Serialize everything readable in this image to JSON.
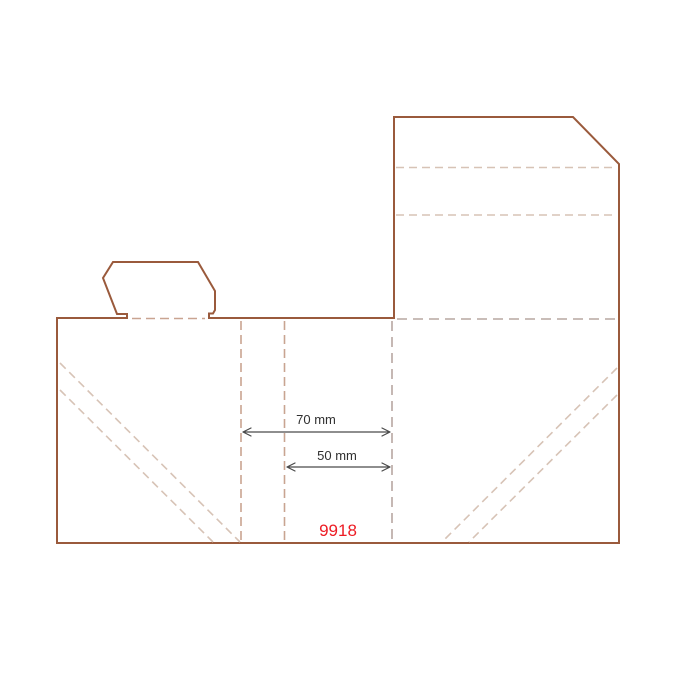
{
  "drawing": {
    "dimension_70": {
      "label": "70 mm",
      "value_mm": 70
    },
    "dimension_50": {
      "label": "50 mm",
      "value_mm": 50
    },
    "drawing_number": {
      "label": "9918"
    }
  },
  "colors": {
    "cut_line": "#9a5a3c",
    "fold_line": "#c9a491",
    "fold_line_light": "#d7c3b6",
    "fold_line_gray": "#b7a7a1",
    "dimension_line": "#4a4a4a",
    "dimension_text": "#2f2f2f",
    "drawing_number": "#ed1c24",
    "background": "#ffffff"
  }
}
